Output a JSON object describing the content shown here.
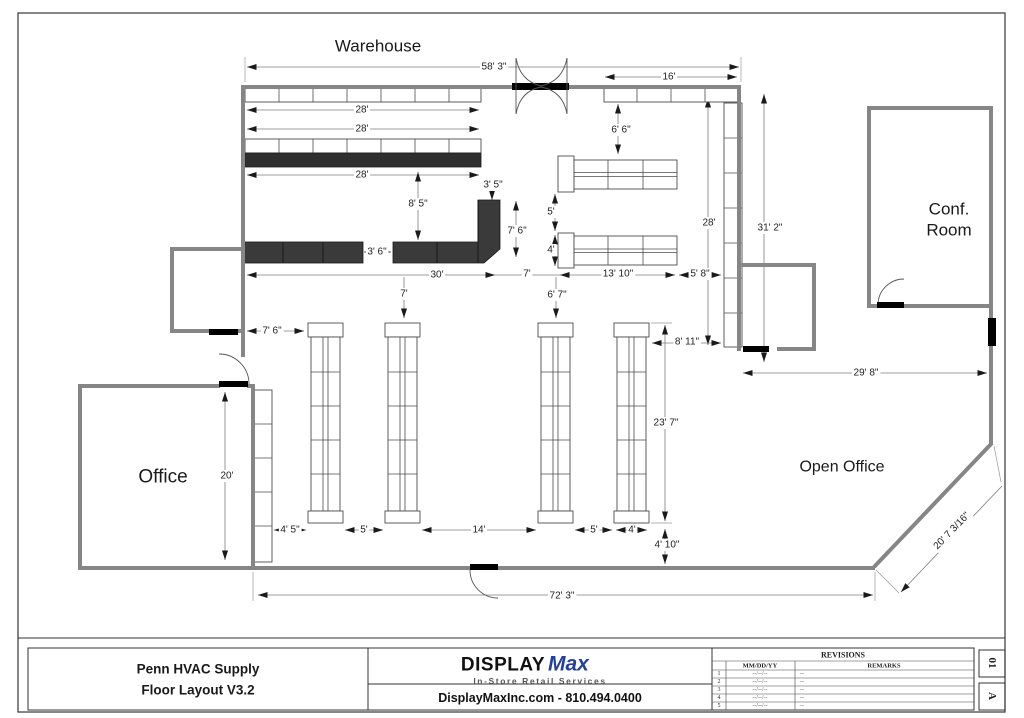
{
  "plan": {
    "rooms": {
      "warehouse": "Warehouse",
      "office": "Office",
      "conf_line1": "Conf.",
      "conf_line2": "Room",
      "open_office": "Open Office"
    },
    "dims": {
      "overall_top": "58' 3\"",
      "top_right_run": "16'",
      "shelf_row_top": "28'",
      "shelf_row_mid": "28'",
      "shelf_row_bottom": "28'",
      "shelf_to_gondola": "6' 6\"",
      "counter_return_width": "3' 5\"",
      "shelf_to_counter": "8' 5\"",
      "counter_return_len": "7' 6\"",
      "mid_gondola_gap": "5'",
      "mid_gondola_depth": "4'",
      "side_shelf_run": "28'",
      "side_height": "31' 2\"",
      "counter_gap": "3' 6\"",
      "counter_run": "30'",
      "counter_to_mid": "7'",
      "mid_gondola_len": "13' 10\"",
      "mid_to_side_shelf": "5' 8\"",
      "counter_to_floor_gondola": "7'",
      "mid_to_floor_gondola": "6' 7\"",
      "wall_to_gondola1": "7' 6\"",
      "gondola4_to_room": "8' 11\"",
      "room_to_wall": "29' 8\"",
      "office_depth": "20'",
      "strip_to_gondola1": "4' 5\"",
      "gap_g1_g2": "5'",
      "gap_g2_g3": "14'",
      "gap_g3_g4": "5'",
      "gondola4_width": "4'",
      "floor_gondola_len": "23' 7\"",
      "gondola_to_wall": "4' 10\"",
      "overall_bottom": "72' 3\"",
      "diagonal_wall": "20' 7 3/16\""
    },
    "colors": {
      "wall": "#868686",
      "counter": "#3a3a3a",
      "shelf_dark": "#2f2f2f",
      "logo_blue": "#24409e"
    }
  },
  "title_block": {
    "project_line1": "Penn HVAC Supply",
    "project_line2": "Floor Layout V3.2",
    "logo_display": "DISPLAY",
    "logo_max": "Max",
    "logo_tagline": "In-Store Retail Services",
    "contact": "DisplayMaxInc.com - 810.494.0400",
    "revisions_title": "REVISIONS",
    "rev_col_date": "MM/DD/YY",
    "rev_col_remarks": "REMARKS",
    "rev_rows": [
      {
        "num": "1",
        "date": "--/--/--",
        "remark": "--"
      },
      {
        "num": "2",
        "date": "--/--/--",
        "remark": "--"
      },
      {
        "num": "3",
        "date": "--/--/--",
        "remark": "--"
      },
      {
        "num": "4",
        "date": "--/--/--",
        "remark": "--"
      },
      {
        "num": "5",
        "date": "--/--/--",
        "remark": "--"
      }
    ],
    "sheet_number": "01",
    "sheet_letter": "A"
  }
}
